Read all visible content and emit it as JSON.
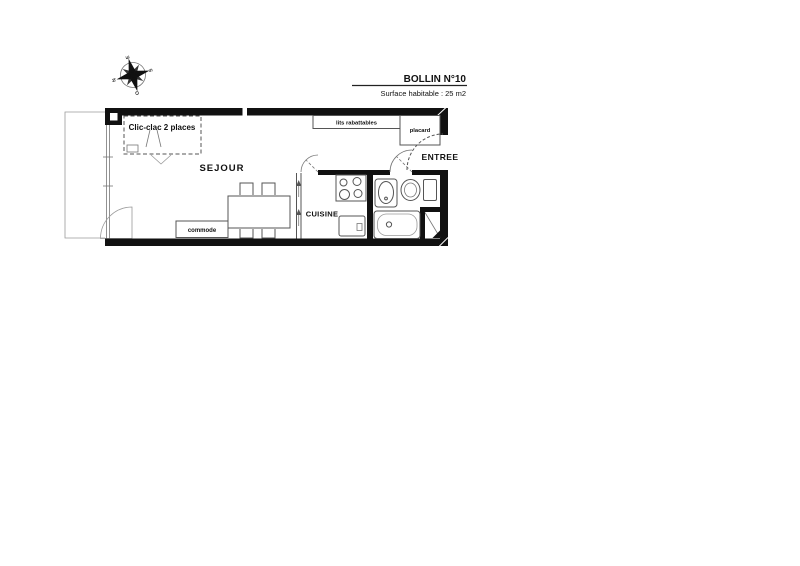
{
  "title_block": {
    "project": "BOLLIN N°10",
    "surface": "Surface habitable : 25 m2"
  },
  "compass": {
    "left": "N",
    "top": "E",
    "right": "S",
    "bottom": "O"
  },
  "rooms": {
    "sejour": "SEJOUR",
    "cuisine": "CUISINE",
    "entree": "ENTREE"
  },
  "furniture": {
    "clic_clac": "Clic-clac 2 places",
    "commode": "commode",
    "lits_rabattables": "lits rabattables",
    "placard": "placard"
  },
  "colors": {
    "wall": "#111111",
    "line_medium": "#555555",
    "line_light": "#9a9a9a",
    "text": "#111111",
    "background": "#ffffff"
  }
}
